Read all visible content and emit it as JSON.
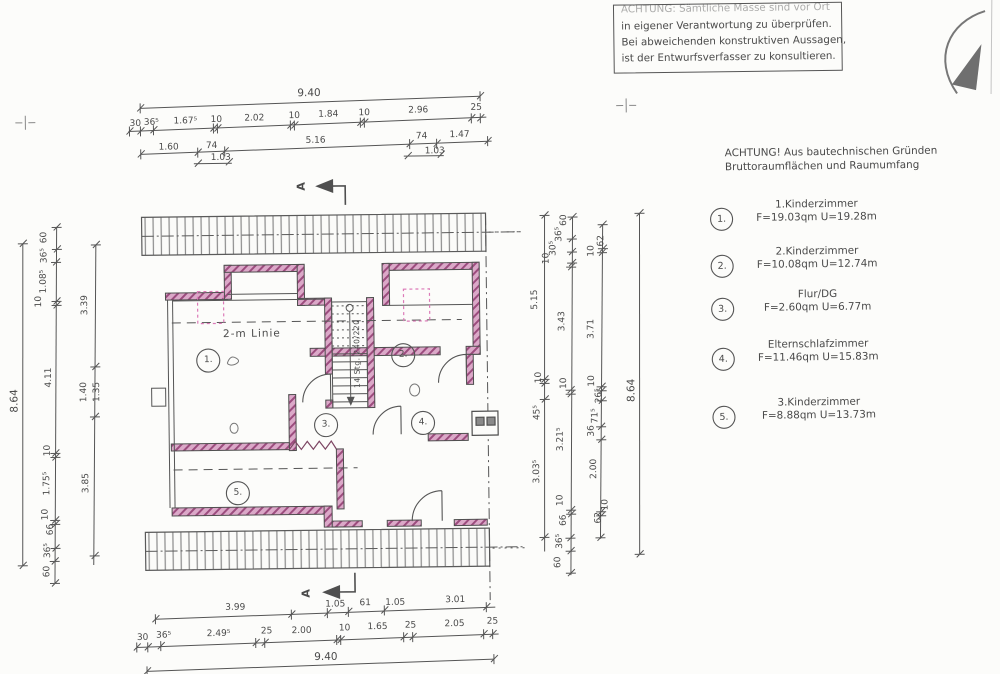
{
  "disclaimer": {
    "lines": [
      "ACHTUNG: Sämtliche Masse sind vor Ort",
      "in eigener Verantwortung zu überprüfen.",
      "Bei abweichenden konstruktiven Aussagen,",
      "ist der Entwurfsverfasser zu konsultieren."
    ]
  },
  "note": {
    "lines": [
      "ACHTUNG! Aus bautechnischen Gründen",
      "Bruttoraumflächen und Raumumfang"
    ]
  },
  "legend": {
    "rooms": [
      {
        "num": "1.",
        "name": "1.Kinderzimmer",
        "metrics": "F=19.03qm U=19.28m"
      },
      {
        "num": "2.",
        "name": "2.Kinderzimmer",
        "metrics": "F=10.08qm U=12.74m"
      },
      {
        "num": "3.",
        "name": "Flur/DG",
        "metrics": "F=2.60qm U=6.77m"
      },
      {
        "num": "4.",
        "name": "Elternschlafzimmer",
        "metrics": "F=11.46qm U=15.83m"
      },
      {
        "num": "5.",
        "name": "3.Kinderzimmer",
        "metrics": "F=8.88qm U=13.73m"
      }
    ]
  },
  "plan": {
    "two_m_line": "2-m Linie",
    "stair": "14 Stg. 240/220",
    "section_marker": "A",
    "rooms": [
      "1.",
      "2.",
      "3.",
      "4.",
      "5."
    ]
  },
  "dims": {
    "top": {
      "total": "9.40",
      "row2": [
        "30",
        "36⁵",
        "1.67⁵",
        "10",
        "2.02",
        "10",
        "1.84",
        "10",
        "2.96",
        "25"
      ],
      "row3": [
        "1.60",
        "74",
        "5.16",
        "74",
        "1.47"
      ],
      "row3_sub": [
        "1.03",
        "1.03"
      ]
    },
    "bottom": {
      "row1": [
        "3.99",
        "1.05",
        "61",
        "1.05",
        "3.01"
      ],
      "row2": [
        "30",
        "36⁵",
        "2.49⁵",
        "25",
        "2.00",
        "10",
        "1.65",
        "25",
        "2.05",
        "25"
      ],
      "total": "9.40"
    },
    "left": {
      "total": "8.64",
      "chainB": [
        "60",
        "36⁵",
        "1.08⁵",
        "10",
        "4.11",
        "10",
        "1.75⁵",
        "10",
        "66",
        "36⁵",
        "60"
      ],
      "chainC": [
        "3.39",
        "1.40",
        "1.35",
        "3.85"
      ]
    },
    "right": {
      "chain1": [
        "5.15",
        "10",
        "45⁵",
        "3.03⁵"
      ],
      "chain2": [
        "60",
        "36⁵",
        "30⁵",
        "10",
        "3.43",
        "10",
        "3.21⁵",
        "10",
        "66",
        "36⁵",
        "60"
      ],
      "chain3": [
        "62",
        "10",
        "3.71",
        "10",
        "26⁵",
        "71⁵",
        "36",
        "2.00",
        "10",
        "62"
      ],
      "total": "8.64"
    }
  }
}
